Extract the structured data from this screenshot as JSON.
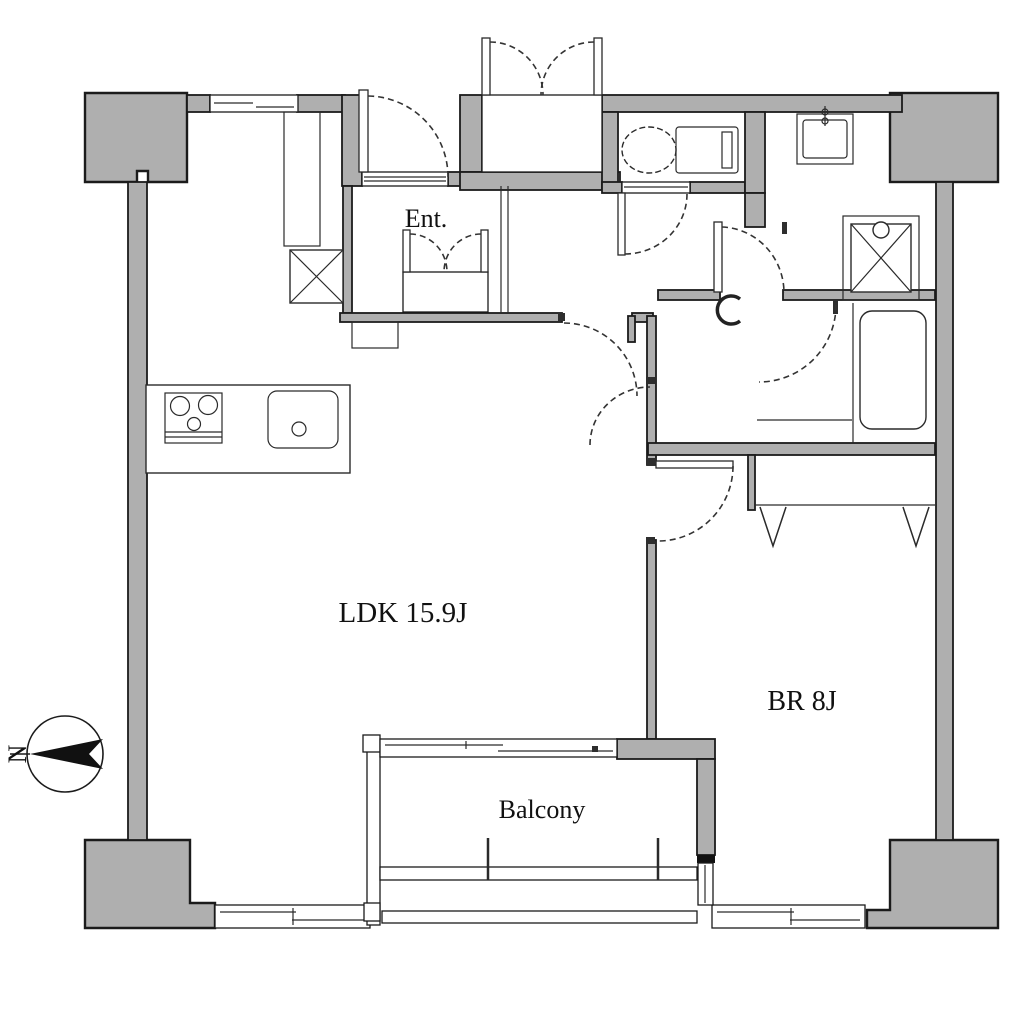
{
  "document": {
    "type": "apartment-floor-plan"
  },
  "labels": {
    "entrance": "Ent.",
    "ldk": "LDK 15.9J",
    "bedroom": "BR 8J",
    "balcony": "Balcony",
    "compass_north": "N"
  },
  "rooms": [
    {
      "id": "ldk",
      "name": "Living Dining Kitchen",
      "label": "LDK 15.9J",
      "size_tatami": 15.9
    },
    {
      "id": "bedroom",
      "name": "Bedroom",
      "label": "BR 8J",
      "size_tatami": 8
    },
    {
      "id": "balcony",
      "name": "Balcony",
      "label": "Balcony"
    },
    {
      "id": "entrance",
      "name": "Entrance hall",
      "label": "Ent."
    }
  ],
  "icons": [
    "compass-north-icon",
    "stove-icon",
    "kitchen-sink-icon",
    "toilet-icon",
    "washbasin-icon",
    "washing-machine-icon",
    "bathtub-icon",
    "pipe-shaft-icon",
    "duct-icon",
    "shoe-closet-icon",
    "meter-box-icon",
    "closet-hanger-icon",
    "door-swing-icon",
    "sliding-window-icon"
  ],
  "colors": {
    "wall_fill": "#afafaf",
    "line": "#1b1b1b",
    "background": "#ffffff"
  }
}
